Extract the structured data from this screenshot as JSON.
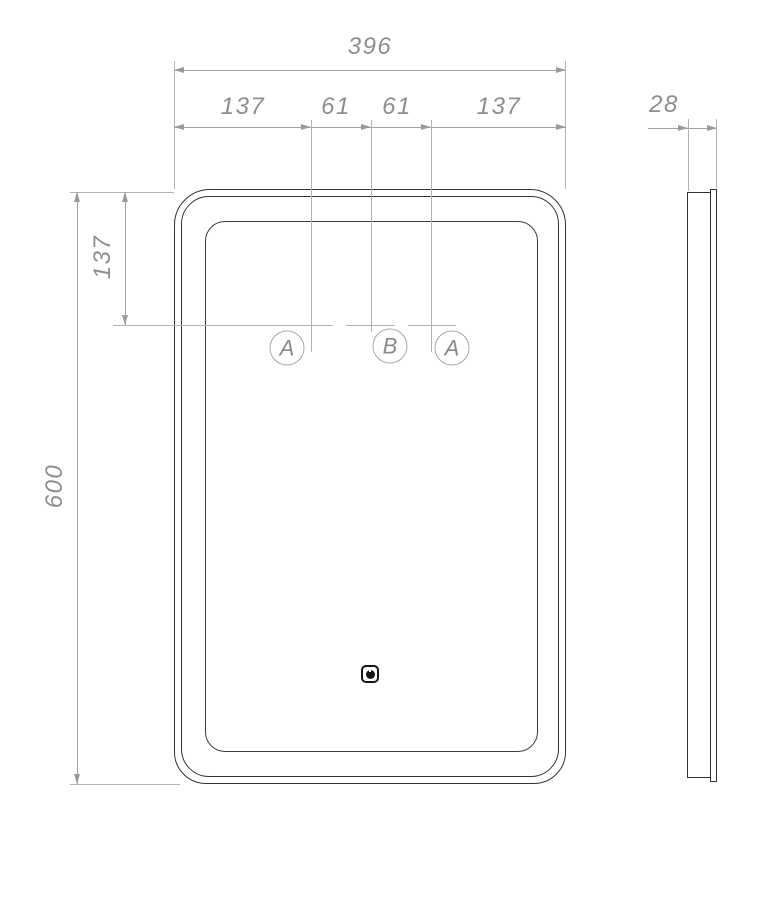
{
  "drawing": {
    "type": "technical-dimension-drawing",
    "subject": "rounded-rectangular-mirror-front-and-side-view",
    "front_view": {
      "overall_width": "396",
      "width_segments": [
        "137",
        "61",
        "61",
        "137"
      ],
      "overall_height": "600",
      "mount_offset_top": "137",
      "mount_labels": [
        "A",
        "B",
        "A"
      ]
    },
    "side_view": {
      "depth": "28"
    },
    "icons": {
      "sensor": "power-touch-sensor-icon"
    },
    "colors": {
      "outline": "#333333",
      "dimension_line": "#a2a2a2",
      "dimension_text": "#8e8e8e",
      "sensor_icon": "#161616"
    }
  }
}
